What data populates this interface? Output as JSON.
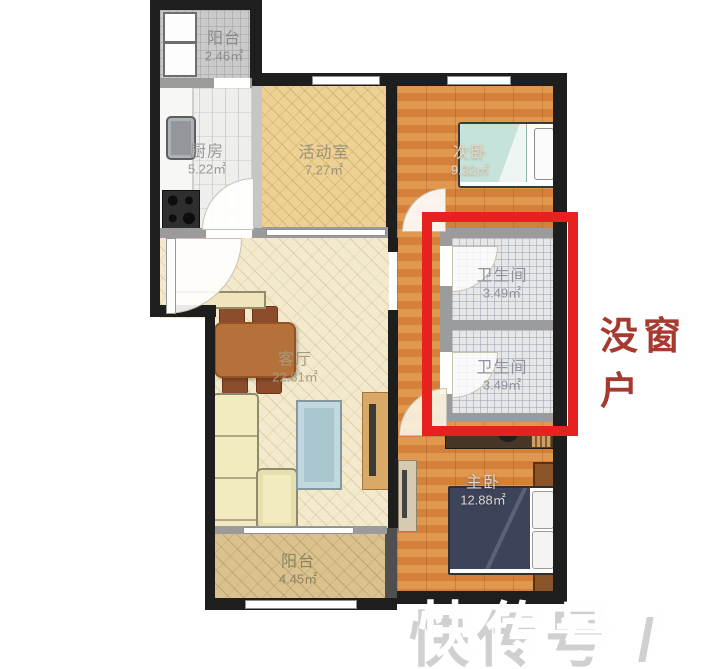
{
  "rooms": {
    "balcony_top": {
      "name": "阳台",
      "area": "2.46㎡"
    },
    "kitchen": {
      "name": "厨房",
      "area": "5.22㎡"
    },
    "activity_room": {
      "name": "活动室",
      "area": "7.27㎡"
    },
    "second_bedroom": {
      "name": "次卧",
      "area": "9.32㎡"
    },
    "bathroom_top": {
      "name": "卫生间",
      "area": "3.49㎡"
    },
    "bathroom_bottom": {
      "name": "卫生间",
      "area": "3.49㎡"
    },
    "living_room": {
      "name": "客厅",
      "area": "22.81㎡"
    },
    "balcony_bottom": {
      "name": "阳台",
      "area": "4.45㎡"
    },
    "master_bedroom": {
      "name": "主卧",
      "area": "12.88㎡"
    }
  },
  "annotations": {
    "no_window_note": "没窗户",
    "watermark": "快传号 /"
  },
  "colors": {
    "highlight_red": "#e6211f",
    "note_red": "#a63a30",
    "wall_black": "#1e1e1e",
    "partition_gray": "#9b9b9b"
  }
}
